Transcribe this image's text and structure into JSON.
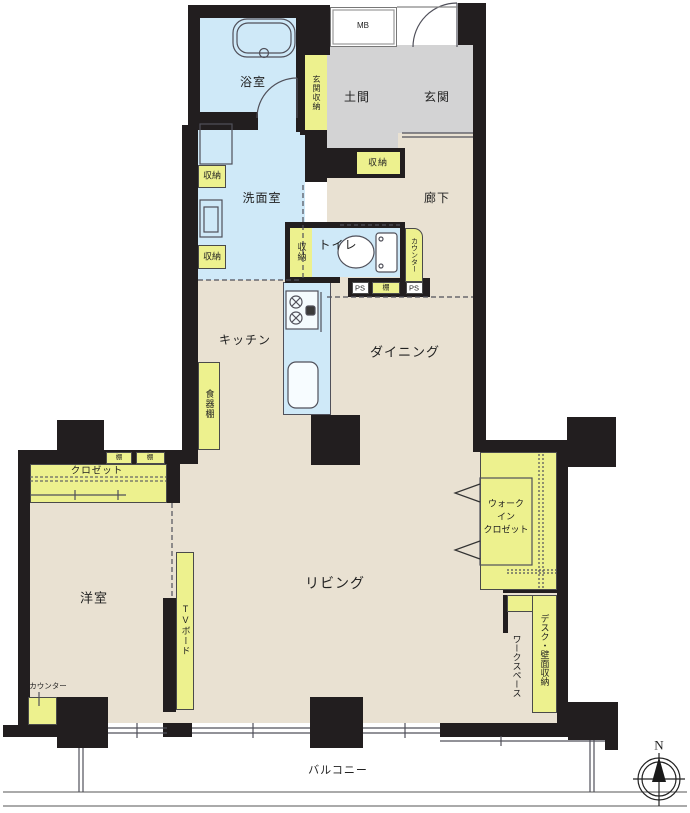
{
  "colors": {
    "wall": "#221e1f",
    "floor_beige": "#e9e1d2",
    "water_blue": "#cfe9f8",
    "doma_gray": "#d3d3d4",
    "storage_yellow": "#edf18e",
    "line": "#50505a",
    "text": "#222222",
    "background": "#ffffff"
  },
  "labels": {
    "bathroom": "浴室",
    "meter_box": "MB",
    "entrance_storage": "玄関収納",
    "doma": "土間",
    "entrance": "玄関",
    "washroom": "洗面室",
    "storage": "収納",
    "hallway": "廊下",
    "toilet": "トイレ",
    "counter": "カウンター",
    "pipe_space": "PS",
    "shelf": "棚",
    "kitchen": "キッチン",
    "dining": "ダイニング",
    "cupboard": "食器棚",
    "closet": "クロゼット",
    "walk_in_closet_line1": "ウォーク",
    "walk_in_closet_line2": "イン",
    "walk_in_closet_line3": "クロゼット",
    "western_room": "洋室",
    "tv_board": "TVボード",
    "living": "リビング",
    "desk_wall_storage": "デスク・壁面収納",
    "workspace": "ワークスペース",
    "balcony": "バルコニー",
    "compass_north": "N"
  }
}
